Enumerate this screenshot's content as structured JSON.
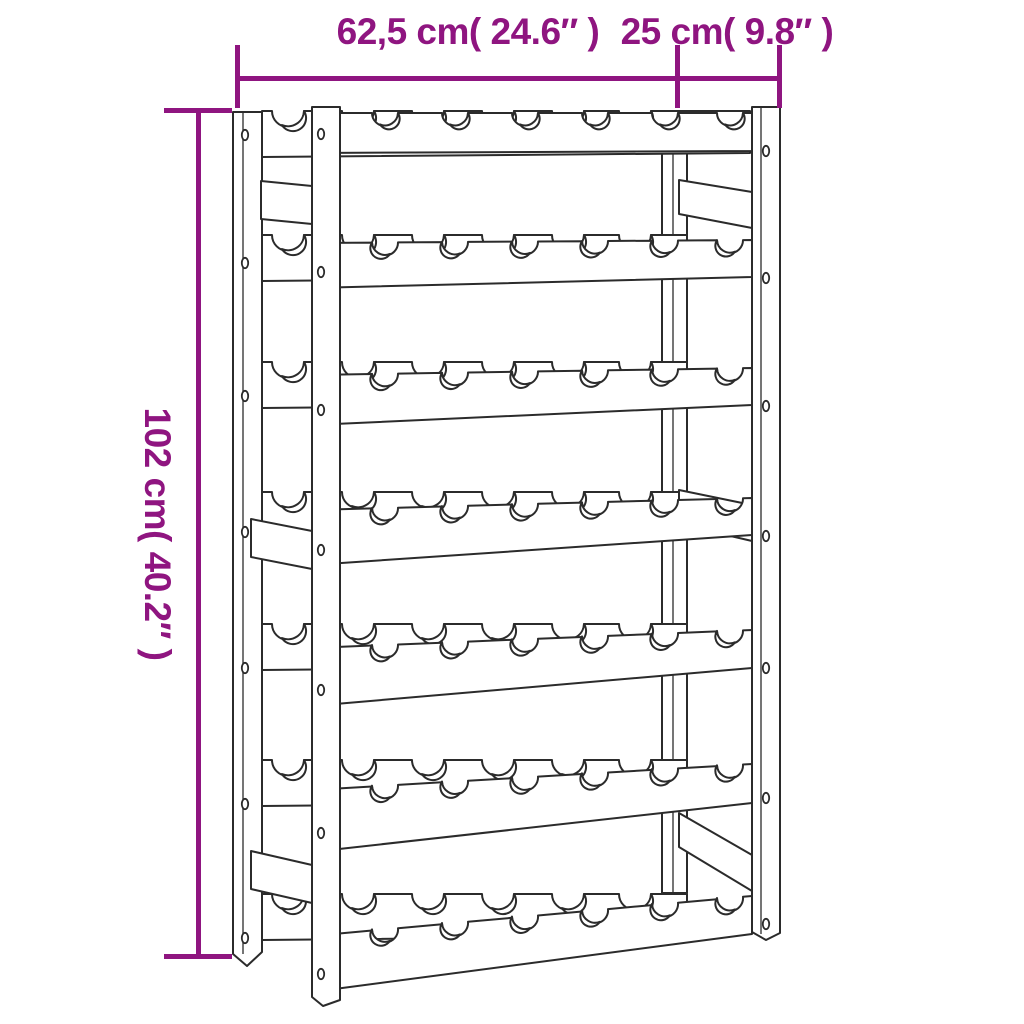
{
  "diagram": {
    "kind": "product dimension line drawing",
    "product": "wine bottle rack",
    "labels": {
      "width": "62,5 cm( 24.6″ )",
      "depth": "25 cm( 9.8″ )",
      "height": "102 cm( 40.2″ )"
    },
    "structure": {
      "shelf_rows": 7,
      "bottle_slots_per_row": 6,
      "side_rails_per_side": 3
    },
    "colors": {
      "dimension_accent": "#8F1580",
      "drawing_line": "#2b2b2b",
      "background": "#FFFFFF"
    }
  }
}
